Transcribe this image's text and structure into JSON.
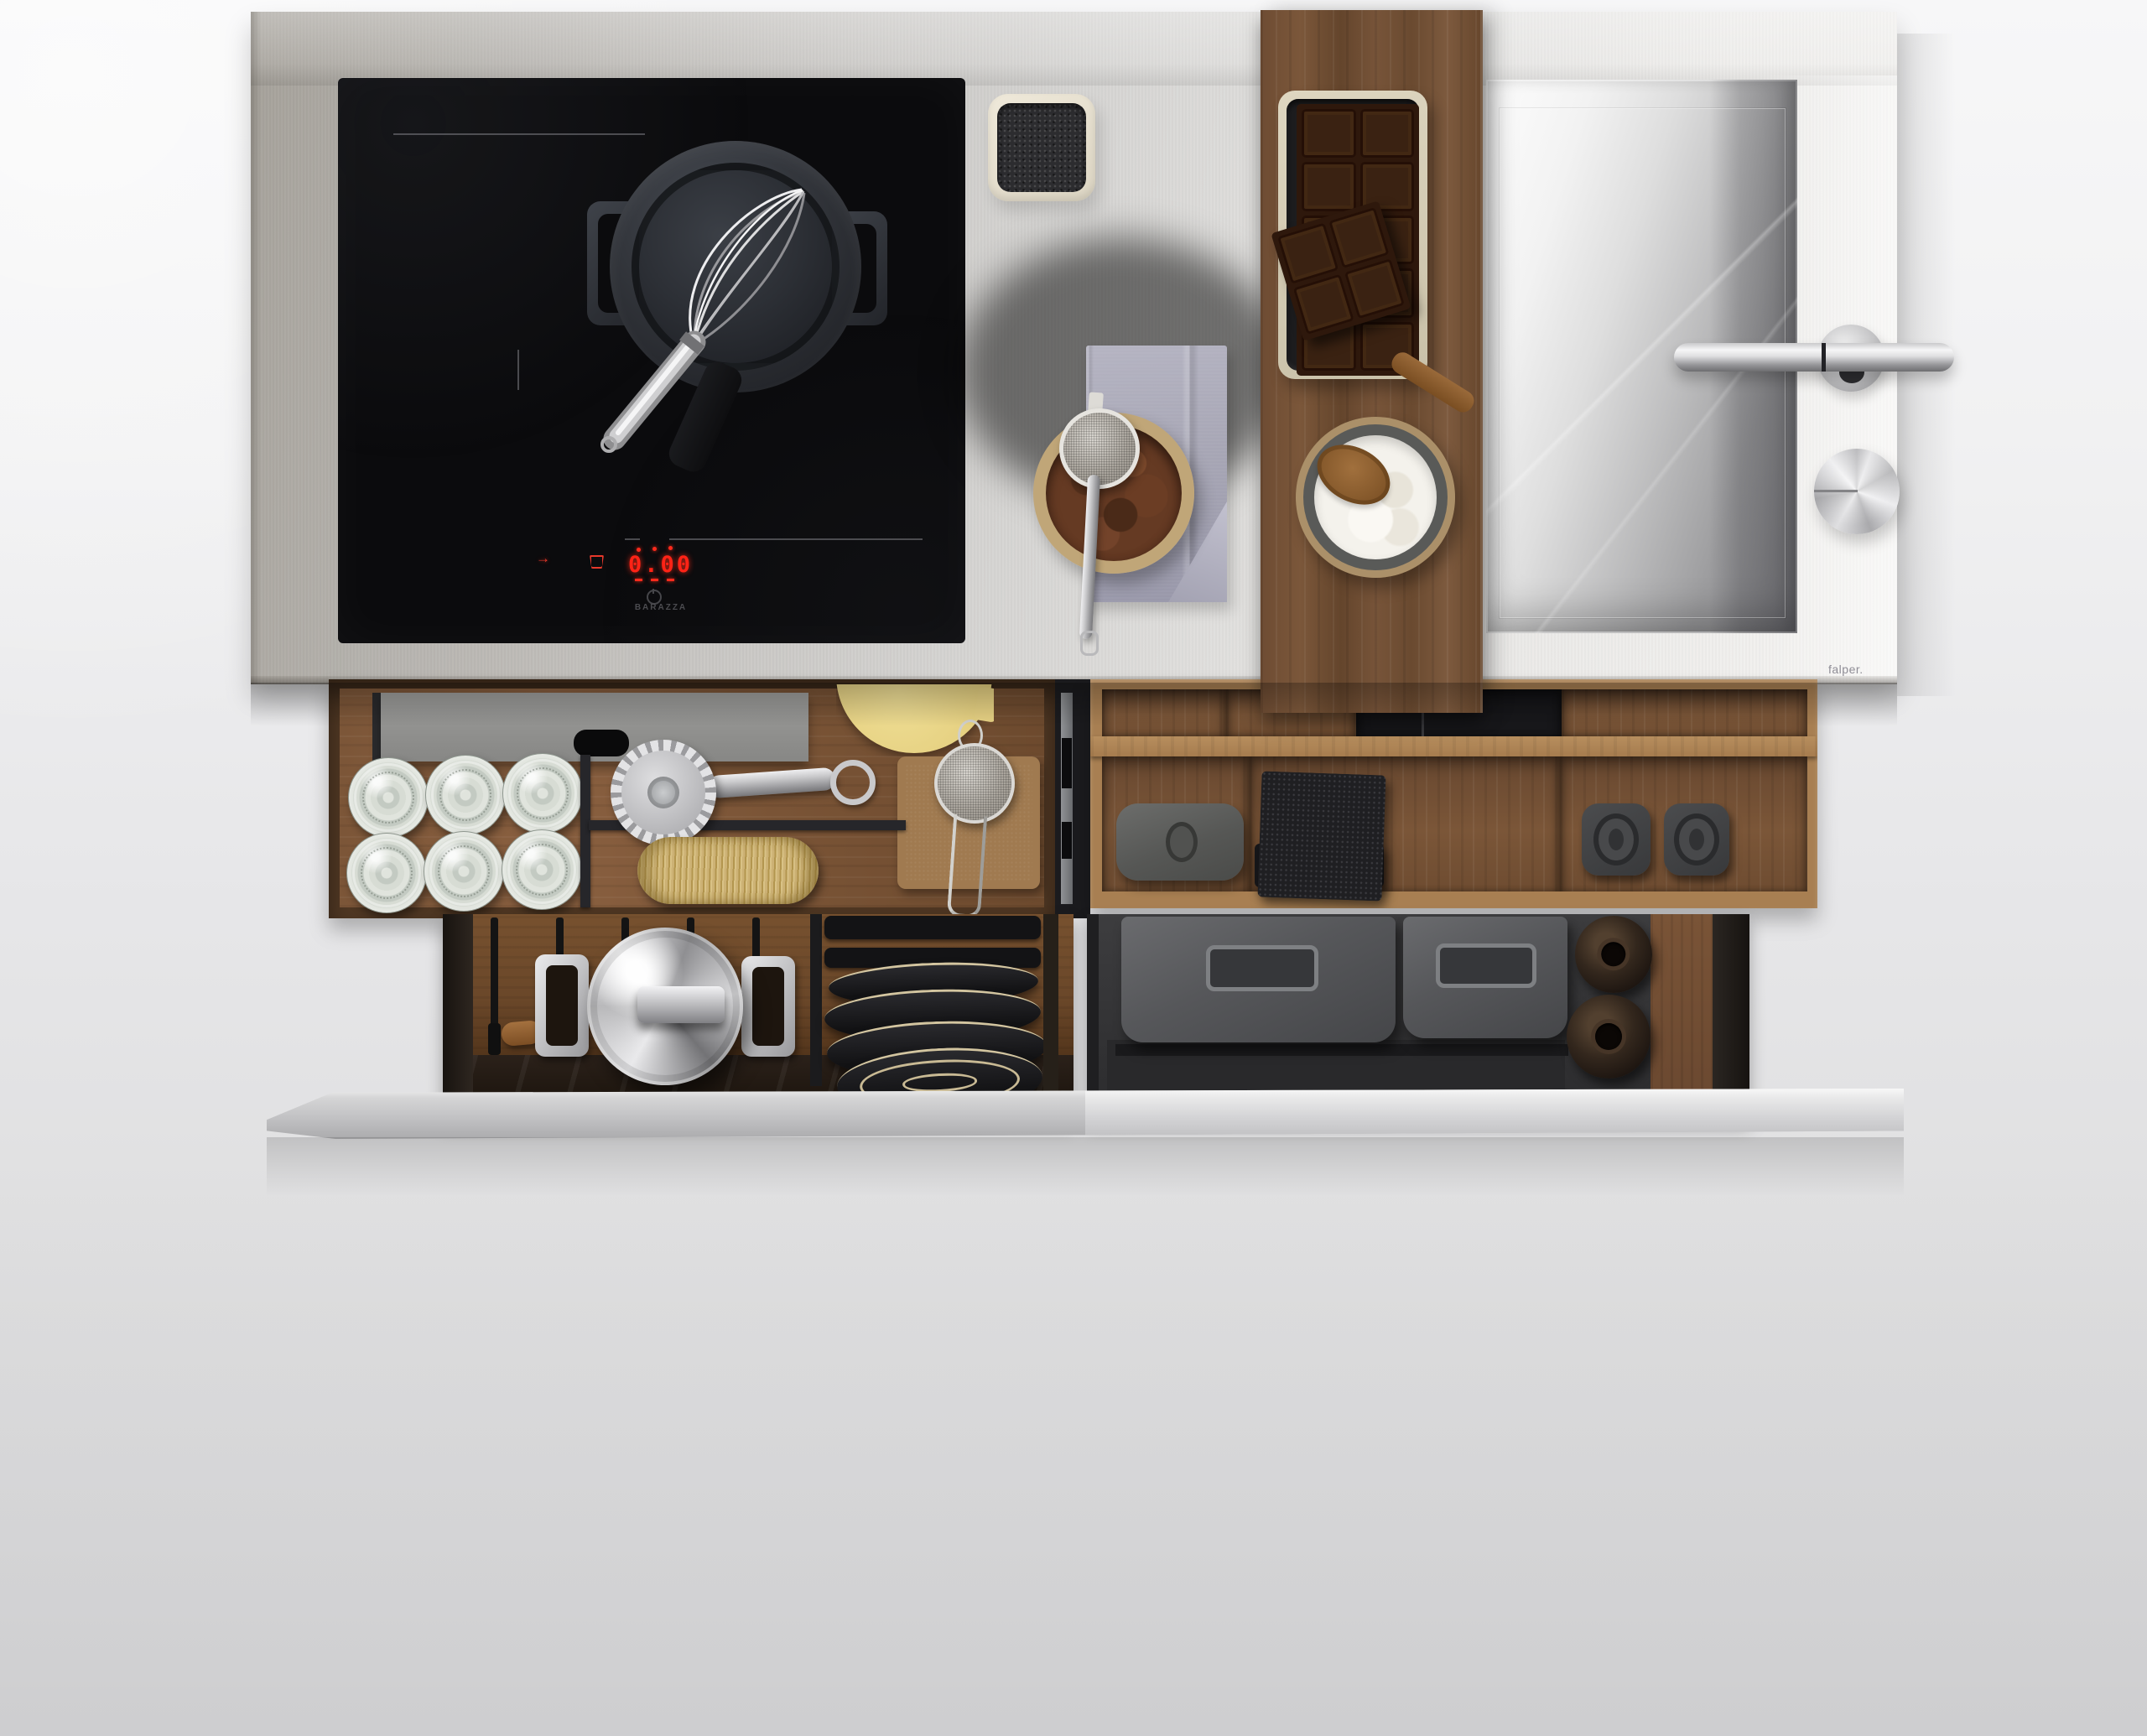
{
  "cooktop": {
    "brand": "BARAZZA",
    "display_value": "0.00",
    "accent_color": "#e8291c",
    "surface_color": "#0b0b0d"
  },
  "counter": {
    "brand": "falper.",
    "steel_light": "#f4f3f1",
    "steel_dark": "#a5a19a"
  },
  "palette": {
    "walnut": "#6b4a2f",
    "oak": "#a87f52",
    "napkin_lavender": "#a7a6b5",
    "cocoa_brown": "#653a23",
    "chocolate_dark": "#2e180c",
    "flour_white": "#f4f2ec",
    "twine_gold": "#c4a96b",
    "butter_disc_yellow": "#ead687",
    "sponge_charcoal": "#2c2c2f"
  },
  "scene": {
    "description": "Top-down photograph of a stainless steel kitchen island with induction cooktop, integrated sink and two open walnut organizer drawers over a steel shelf",
    "objects": [
      "induction cooktop with saucepan and whisk",
      "square ceramic dish with charcoal sponge",
      "walnut board with chocolate bar on tray",
      "lavender linen napkin",
      "bowl of cocoa powder with mesh strainer",
      "bowl of flour with wooden spoon",
      "rectangular stainless sink with lever faucet and round knob",
      "drawer with glass jars, pasta cutter, twine and strainer on slate tray",
      "drawer organizer with rubber containers, woven mats and canisters",
      "lower drawer with steel pot lid and stack of black plates",
      "lower drawer with metal bins and oil jugs",
      "cantilevered steel shelf"
    ]
  }
}
